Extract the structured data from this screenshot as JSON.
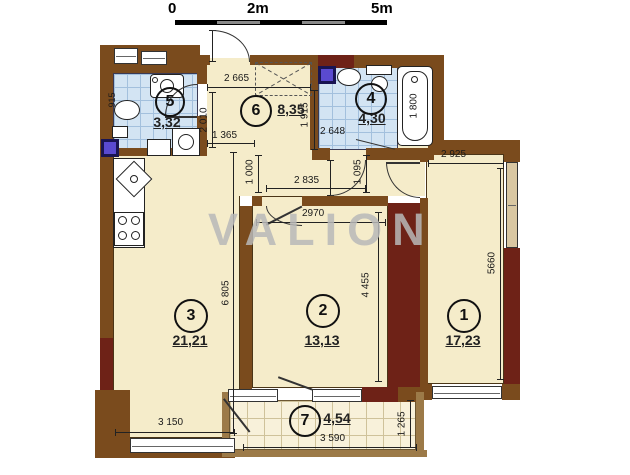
{
  "scale_bar": {
    "labels": [
      "0",
      "2m",
      "5m"
    ]
  },
  "watermark": {
    "text": "VALION"
  },
  "rooms": {
    "r1": {
      "number": "1",
      "area": "17,23"
    },
    "r2": {
      "number": "2",
      "area": "13,13"
    },
    "r3": {
      "number": "3",
      "area": "21,21"
    },
    "r4": {
      "number": "4",
      "area": "4,30"
    },
    "r5": {
      "number": "5",
      "area": "3,32"
    },
    "r6": {
      "number": "6",
      "area": "8,35"
    },
    "r7": {
      "number": "7",
      "area": "4,54"
    }
  },
  "dims": {
    "hall_top": "2 665",
    "hall_door": "1 365",
    "hall_depth": "2 010",
    "bath4_depth": "1 915",
    "bath4_width": "2 648",
    "tub": "1 800",
    "bath5_width": "915",
    "room1_width": "2 925",
    "room1_depth": "5660",
    "corr_seg_left": "1 000",
    "corr_width": "2 835",
    "corr_seg_right": "1 095",
    "room2_width": "2970",
    "room2_depth": "4 455",
    "room3_depth": "6 805",
    "room3_width": "3 150",
    "balcony_width": "3 590",
    "balcony_depth": "1 265"
  },
  "colors": {
    "wall_brown": "#7a4b1d",
    "wall_maroon": "#6e2217",
    "floor_beige": "#f5ecca",
    "tile_blue": "#d3e4f3",
    "balcony_tile": "#f8f1da",
    "shaft_purple": "#5a4ad0",
    "watermark_gray": "#b9b9b9"
  }
}
